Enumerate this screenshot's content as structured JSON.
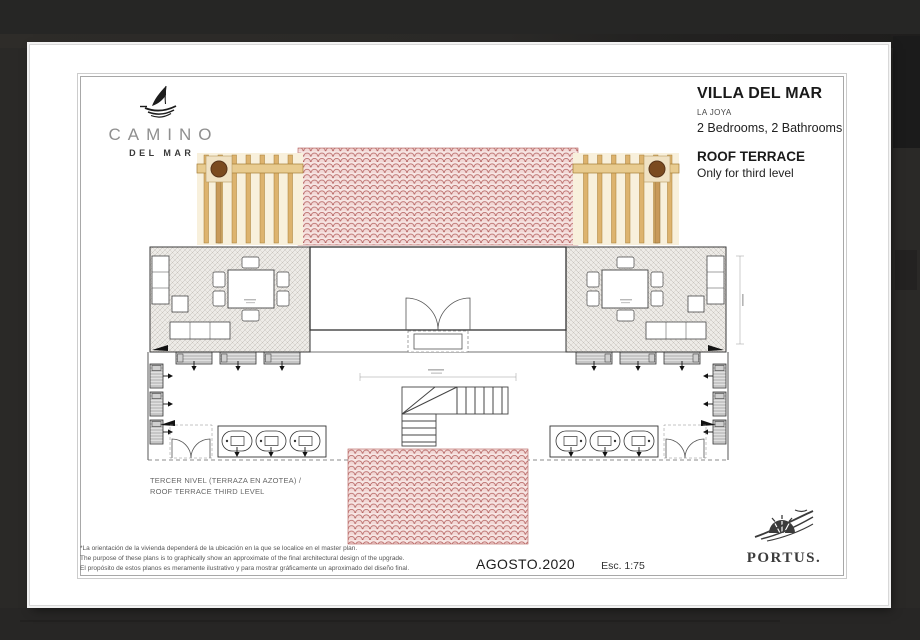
{
  "brand": {
    "name": "CAMINO",
    "sub": "DEL MAR"
  },
  "title_block": {
    "title": "VILLA DEL MAR",
    "subtitle": "LA JOYA",
    "specs": "2 Bedrooms,  2 Bathrooms",
    "section": "ROOF TERRACE",
    "section_note": "Only for third level"
  },
  "plan": {
    "label_line1": "TERCER NIVEL (TERRAZA EN AZOTEA) /",
    "label_line2": "ROOF TERRACE THIRD LEVEL"
  },
  "disclaimer": {
    "line1": "*La orientación de la vivienda dependerá de la ubicación  en la que se localice en el master plan.",
    "line2": "The purpose of these plans is to graphically show an approximate of the final architectural design of the upgrade.",
    "line3": "El propósito de estos planos es meramente ilustrativo y para mostrar gráficamente un aproximado del diseño final."
  },
  "footer": {
    "date": "AGOSTO.2020",
    "scale": "Esc. 1:75"
  },
  "logo_portus": "PORTUS.",
  "colors": {
    "roof_tile_line": "#b15a58",
    "roof_tile_bg": "#f7e6e4",
    "pergola_wood": "#ddb36e",
    "pergola_beam": "#e8cb8f",
    "pergola_post": "#7b4b20",
    "terrace_hatch": "#b8b4ae",
    "paper": "#ffffff",
    "backdrop": "#2a2927"
  }
}
